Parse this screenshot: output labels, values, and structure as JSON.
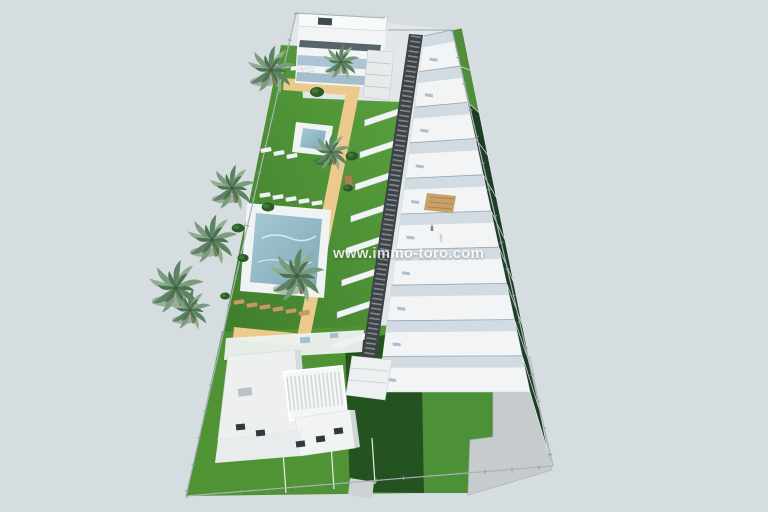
{
  "watermark": {
    "text": "www.immo-toro.com"
  },
  "colors": {
    "background": "#d6dde0",
    "site_base": "#e3e7e9",
    "lawn": "#4f9335",
    "lawn_light": "#5aa33f",
    "lawn_shadowed": "#1f4a1f",
    "lawn_bright": "#4c9038",
    "garden_strip": "#1e3d26",
    "garden_strip_light": "#528d3e",
    "path": "#ecca8e",
    "pool_deck": "#f0f3f3",
    "pool_water": "#8fb9c8",
    "pool_water_deep": "#6d9db0",
    "walkway": "#3e4347",
    "walkway_slat": "#8a9298",
    "building": "#f2f4f5",
    "building_shade": "#ccd6dd",
    "building_dark": "#3c4a52",
    "glass": "#a3c0d2",
    "fence": "#a9b3b8",
    "paving": "#c6cbce",
    "trunk": "#8a6f52",
    "frond": "#7a9b7c",
    "frond_dark": "#5d8460",
    "frond_light": "#8fae8e",
    "lounger_white": "#eef1f1",
    "lounger_tan": "#c49a63",
    "bush": "#2c5b28",
    "pergola_wood": "#c8a06a",
    "watermark_color": "#ffffff"
  },
  "scene": {
    "units": {
      "count": 10
    },
    "stairs": {
      "count": 8
    },
    "palms": [
      {
        "x": 271,
        "y": 70,
        "s": 1.05
      },
      {
        "x": 341,
        "y": 62,
        "s": 0.8
      },
      {
        "x": 331,
        "y": 152,
        "s": 0.85
      },
      {
        "x": 232,
        "y": 188,
        "s": 1.0
      },
      {
        "x": 212,
        "y": 240,
        "s": 1.1
      },
      {
        "x": 297,
        "y": 276,
        "s": 1.2
      },
      {
        "x": 176,
        "y": 288,
        "s": 1.2
      },
      {
        "x": 190,
        "y": 310,
        "s": 0.9
      }
    ],
    "bushes": [
      {
        "x": 317,
        "y": 92,
        "s": 1.0
      },
      {
        "x": 268,
        "y": 207,
        "s": 0.9
      },
      {
        "x": 238,
        "y": 228,
        "s": 0.9
      },
      {
        "x": 243,
        "y": 258,
        "s": 0.8
      },
      {
        "x": 225,
        "y": 296,
        "s": 0.7
      },
      {
        "x": 352,
        "y": 156,
        "s": 0.9
      },
      {
        "x": 348,
        "y": 188,
        "s": 0.7
      }
    ],
    "loungers": [
      {
        "x": 272,
        "y": 64,
        "r": -8,
        "t": "white"
      },
      {
        "x": 284,
        "y": 66,
        "r": -8,
        "t": "white"
      },
      {
        "x": 296,
        "y": 68,
        "r": -8,
        "t": "white"
      },
      {
        "x": 308,
        "y": 70,
        "r": -8,
        "t": "white"
      },
      {
        "x": 266,
        "y": 150,
        "r": -10,
        "t": "white"
      },
      {
        "x": 279,
        "y": 153,
        "r": -10,
        "t": "white"
      },
      {
        "x": 292,
        "y": 156,
        "r": -10,
        "t": "white"
      },
      {
        "x": 265,
        "y": 195,
        "r": -8,
        "t": "white"
      },
      {
        "x": 278,
        "y": 197,
        "r": -8,
        "t": "white"
      },
      {
        "x": 291,
        "y": 199,
        "r": -8,
        "t": "white"
      },
      {
        "x": 304,
        "y": 201,
        "r": -8,
        "t": "white"
      },
      {
        "x": 317,
        "y": 203,
        "r": -8,
        "t": "white"
      },
      {
        "x": 239,
        "y": 302,
        "r": -8,
        "t": "tan"
      },
      {
        "x": 252,
        "y": 305,
        "r": -8,
        "t": "tan"
      },
      {
        "x": 265,
        "y": 307,
        "r": -8,
        "t": "tan"
      },
      {
        "x": 278,
        "y": 309,
        "r": -8,
        "t": "tan"
      },
      {
        "x": 291,
        "y": 311,
        "r": -8,
        "t": "tan"
      },
      {
        "x": 304,
        "y": 313,
        "r": -8,
        "t": "tan"
      }
    ],
    "bench": {
      "x": 344,
      "y": 176
    },
    "people": [
      {
        "x": 432,
        "y": 226,
        "c": "#5b8fb5"
      },
      {
        "x": 441,
        "y": 237,
        "c": "#d6d7d8"
      }
    ]
  }
}
